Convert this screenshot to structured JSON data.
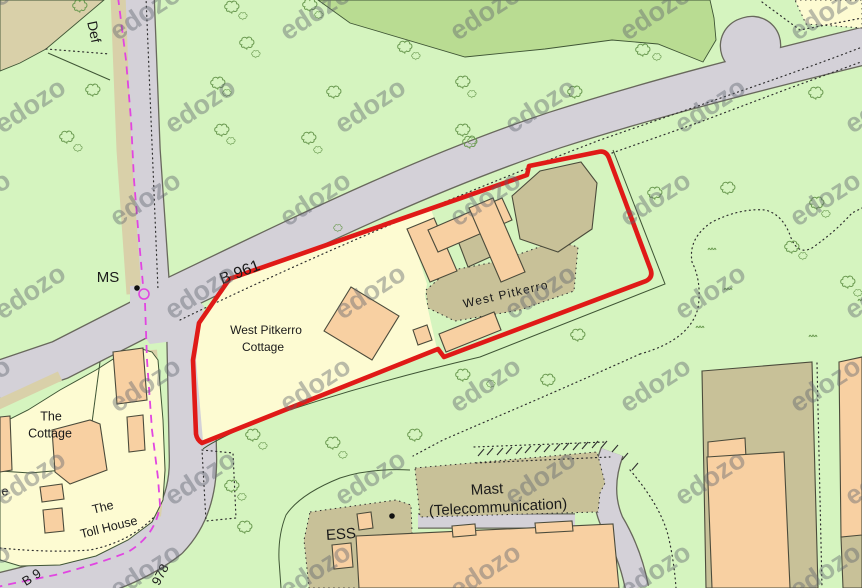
{
  "map": {
    "colors": {
      "green": "#d5f4bf",
      "olive": "#b9dc92",
      "tan": "#d9d0a9",
      "cream": "#fdfbd2",
      "gray": "#d4d1d8",
      "casing": "#68685c",
      "khaki": "#c8c198",
      "peach": "#f8d0a2",
      "building_outline": "#4b4b3b",
      "line": "#3f5535",
      "dotted": "#2f2f2f",
      "tree": "#6b9a51",
      "red": "#e01a17",
      "magenta": "#e145e1",
      "text": "#1a1a1a",
      "watermark": "#5f646e"
    },
    "watermark": {
      "text": "edozo",
      "rows": 7,
      "cols": 6,
      "dx": 170,
      "dy": 93,
      "x0": -20,
      "y0": 20,
      "odd_offset": 55,
      "rot": -33,
      "size": 27,
      "opacity": 0.42
    },
    "labels": [
      {
        "id": "label-def",
        "text": "Def",
        "x": 93,
        "y": 32,
        "rot": 78,
        "fs": 14
      },
      {
        "id": "label-ms",
        "text": "MS",
        "x": 108,
        "y": 278,
        "rot": 0,
        "fs": 15
      },
      {
        "id": "label-b961",
        "text": "B 961",
        "x": 240,
        "y": 273,
        "rot": -21,
        "fs": 16
      },
      {
        "id": "label-west-pitkerro-cottage-1",
        "text": "West Pitkerro",
        "x": 266,
        "y": 331,
        "rot": 0,
        "fs": 12
      },
      {
        "id": "label-west-pitkerro-cottage-2",
        "text": "Cottage",
        "x": 263,
        "y": 348,
        "rot": 0,
        "fs": 12
      },
      {
        "id": "label-west-pitkerro",
        "text": "West Pitkerro",
        "x": 506,
        "y": 295,
        "rot": -13,
        "fs": 12,
        "ls": 1.2
      },
      {
        "id": "label-the-cottage-1",
        "text": "The",
        "x": 51,
        "y": 417,
        "rot": 0,
        "fs": 12.5
      },
      {
        "id": "label-the-cottage-2",
        "text": "Cottage",
        "x": 50,
        "y": 434,
        "rot": 0,
        "fs": 12.5
      },
      {
        "id": "label-toll-house-1",
        "text": "The",
        "x": 103,
        "y": 508,
        "rot": -14,
        "fs": 12.5
      },
      {
        "id": "label-toll-house-2",
        "text": "Toll House",
        "x": 109,
        "y": 528,
        "rot": -14,
        "fs": 12.5
      },
      {
        "id": "label-e-partial",
        "text": "e",
        "x": 5,
        "y": 492,
        "rot": 0,
        "fs": 12.5
      },
      {
        "id": "label-ess",
        "text": "ESS",
        "x": 341,
        "y": 535,
        "rot": -4,
        "fs": 15
      },
      {
        "id": "label-mast-1",
        "text": "Mast",
        "x": 487,
        "y": 490,
        "rot": -3,
        "fs": 15
      },
      {
        "id": "label-mast-2",
        "text": "(Telecommunication)",
        "x": 498,
        "y": 508,
        "rot": -3,
        "fs": 15
      },
      {
        "id": "label-978",
        "text": "978",
        "x": 161,
        "y": 575,
        "rot": -62,
        "fs": 13
      },
      {
        "id": "label-b9-partial",
        "text": "B 9",
        "x": 32,
        "y": 578,
        "rot": -33,
        "fs": 13
      }
    ],
    "areas1": [
      {
        "name": "woodland-patch-top",
        "pts": "318,0 350,23 465,57 545,49 612,40 658,44 703,62 716,40 714,18 710,0",
        "fill": "olive",
        "stroke": true
      },
      {
        "name": "rough-ground-top-left",
        "pts": "0,0 104,0 46,49 20,63 0,71",
        "fill": "tan",
        "stroke": true
      }
    ],
    "roads": [
      {
        "name": "road-b961-main",
        "d": "M160,302 C300,235 420,175 555,130 C680,90 800,62 880,42",
        "w": 36
      },
      {
        "name": "road-layby-bulge",
        "d": "M749,46 L752,45",
        "w": 56,
        "cap": "round"
      },
      {
        "name": "road-north",
        "d": "M136,-5 L142,150 L152,296",
        "w": 35
      },
      {
        "name": "road-west",
        "d": "M162,308 L60,360 L-5,382",
        "w": 38
      },
      {
        "name": "road-south-b978",
        "d": "M190,312 L193,460 Q193,508 166,536 Q128,566 60,582 L-5,598",
        "w": 46
      },
      {
        "name": "road-mast-access",
        "d": "M418,521 L575,521",
        "w": 13
      },
      {
        "name": "road-southeast",
        "d": "M612,452 Q598,490 612,522 Q630,552 637,588",
        "w": 22
      }
    ],
    "verges": [
      {
        "name": "verge-north-road",
        "d": "M118,-5 L124,150 L134,294",
        "w": 15
      },
      {
        "name": "verge-south-road",
        "d": "M152,350 L161,470 L156,516",
        "w": 10
      },
      {
        "name": "verge-west-road",
        "d": "M60,376 L-5,406",
        "w": 10
      }
    ],
    "areas2": [
      {
        "name": "road-junction",
        "pts": "130,286 180,284 204,306 198,338 150,344 130,318",
        "fill": "gray"
      },
      {
        "name": "parcel-west-pitkerro-garden",
        "pts": "232,280 430,207 436,223 410,231 427,284 425,296 437,349 203,441 196,360 201,322",
        "fill": "cream"
      },
      {
        "name": "parcel-cottage-tollhouse",
        "pts": "0,424 28,410 60,390 96,370 118,356 142,349 152,352 158,360 163,420 165,470 163,500 152,522 128,540 96,556 60,565 20,566 0,560",
        "fill": "cream",
        "stroke": true
      },
      {
        "name": "parcel-top-right",
        "pts": "795,0 862,0 862,28 806,24",
        "fill": "cream",
        "dash": "1.5 3.5"
      },
      {
        "name": "yard-west-pitkerro",
        "pts": "426,290 448,271 500,261 556,241 578,247 574,291 520,310 455,321 428,308",
        "fill": "khaki",
        "dash": "1.5 3.5"
      },
      {
        "name": "compound-mast",
        "pts": "415,468 597,452 605,483 600,493 598,512 420,517",
        "fill": "khaki",
        "dash": "1.5 3.5"
      },
      {
        "name": "compound-ess",
        "pts": "310,512 396,500 411,505 414,588 309,588 304,540",
        "fill": "khaki",
        "dash": "1.5 3.5"
      }
    ],
    "fences": [
      {
        "name": "field-boundary-east",
        "d": "M613,150 L665,284 L480,357 Q360,385 260,420 Q215,440 203,449"
      },
      {
        "name": "field-boundary-ess-west",
        "d": "M410,470 Q370,468 340,478 Q300,494 286,515 Q278,535 279,560 L281,588"
      },
      {
        "name": "parcel-divider-1",
        "d": "M100,362 L86,468"
      },
      {
        "name": "parcel-divider-2",
        "d": "M86,468 L30,473 L0,471"
      },
      {
        "name": "boundary-top-left",
        "d": "M48,53 L110,80"
      }
    ],
    "dotted": [
      {
        "name": "path-edge-b961-south",
        "d": "M180,320 C320,252 470,190 600,140 C720,98 810,68 880,40"
      },
      {
        "name": "parcel-dotted-east",
        "d": "M612,153 L700,122 L790,88 L880,55"
      },
      {
        "name": "path-edge-north-road",
        "d": "M146,-3 L158,290"
      },
      {
        "name": "pen-below-site",
        "d": "M202,450 L233,453 L236,518 L206,521 L202,450"
      },
      {
        "name": "vegetation-line-east",
        "d": "M640,354 Q690,340 698,308 Q702,282 692,262 Q688,238 712,222 Q740,208 765,210 Q782,214 790,235 Q797,256 812,248 Q835,232 852,213 L862,208"
      },
      {
        "name": "vegetation-line-southeast",
        "d": "M640,354 Q560,390 480,424 L443,440 L413,456"
      },
      {
        "name": "parcel-bottom-dotted",
        "d": "M0,548 Q50,553 90,550 Q130,542 155,516"
      },
      {
        "name": "dotted-step-k4",
        "d": "M706,388 L730,386 L731,370 L812,364"
      },
      {
        "name": "dotted-k4-east",
        "d": "M817,363 L822,588"
      },
      {
        "name": "dotted-top-right",
        "d": "M762,2 L800,30 L862,18"
      },
      {
        "name": "cutting-edge-north",
        "d": "M474,447 L606,442"
      },
      {
        "name": "cutting-edge-south",
        "d": "M476,463 L610,457"
      },
      {
        "name": "boundary-dotted-top-left",
        "d": "M46,49 L110,54"
      },
      {
        "name": "road-edge-dotted-southeast",
        "d": "M630,470 Q660,505 668,535 Q674,560 676,588"
      }
    ],
    "hatch_ticks": [
      [
        478,
        456,
        484,
        449
      ],
      [
        487,
        455,
        493,
        448
      ],
      [
        497,
        455,
        503,
        448
      ],
      [
        506,
        454,
        512,
        447
      ],
      [
        516,
        454,
        522,
        447
      ],
      [
        525,
        453,
        531,
        446
      ],
      [
        535,
        452,
        541,
        445
      ],
      [
        544,
        452,
        550,
        445
      ],
      [
        554,
        451,
        560,
        444
      ],
      [
        563,
        450,
        569,
        443
      ],
      [
        573,
        450,
        579,
        443
      ],
      [
        582,
        449,
        588,
        442
      ],
      [
        592,
        448,
        598,
        441
      ],
      [
        601,
        448,
        607,
        441
      ],
      [
        612,
        452,
        618,
        445
      ],
      [
        622,
        460,
        628,
        453
      ],
      [
        632,
        470,
        638,
        463
      ]
    ],
    "buildings": [
      {
        "name": "building-khaki-main",
        "pts": "512,196 540,171 581,162 597,183 592,229 558,252 520,239",
        "fill": "khaki"
      },
      {
        "name": "building-khaki-middle",
        "pts": "455,233 486,220 499,253 468,267",
        "fill": "khaki"
      },
      {
        "name": "building-khaki-southeast-block",
        "pts": "702,371 812,362 818,588 706,588",
        "fill": "khaki"
      },
      {
        "name": "building-khaki-corner",
        "pts": "841,537 862,533 862,588 843,588",
        "fill": "khaki"
      },
      {
        "name": "building-west-pitkerro-cottage",
        "pts": "324,331 351,287 399,316 372,360",
        "fill": "peach"
      },
      {
        "name": "building-main-west-wing",
        "pts": "407,229 434,218 457,271 430,282",
        "fill": "peach"
      },
      {
        "name": "building-main-north-range",
        "pts": "428,230 502,198 512,220 438,252",
        "fill": "peach"
      },
      {
        "name": "building-main-east-wing",
        "pts": "469,208 493,198 525,272 501,282",
        "fill": "peach"
      },
      {
        "name": "building-outbuilding-small",
        "pts": "413,330 427,325 432,340 418,345",
        "fill": "peach"
      },
      {
        "name": "building-outbuilding-long",
        "pts": "439,334 494,312 501,330 446,352",
        "fill": "peach"
      },
      {
        "name": "building-se-annex-step",
        "pts": "708,442 745,438 746,458 708,460",
        "fill": "peach"
      },
      {
        "name": "building-se-annex",
        "pts": "707,457 784,452 790,588 712,588",
        "fill": "peach"
      },
      {
        "name": "building-east-edge",
        "pts": "839,362 862,357 862,535 841,537",
        "fill": "peach"
      },
      {
        "name": "building-bottom-large",
        "pts": "356,536 613,524 619,588 359,588",
        "fill": "peach"
      },
      {
        "name": "building-bottom-tab-1",
        "pts": "452,526 475,524 476,535 453,537",
        "fill": "peach"
      },
      {
        "name": "building-bottom-tab-2",
        "pts": "535,523 572,521 573,531 536,533",
        "fill": "peach"
      },
      {
        "name": "building-ess-hut-1",
        "pts": "357,514 371,512 373,528 359,530",
        "fill": "peach"
      },
      {
        "name": "building-ess-hut-2",
        "pts": "332,545 351,543 353,567 334,569",
        "fill": "peach"
      },
      {
        "name": "building-tollhouse-north",
        "pts": "113,352 143,348 147,400 117,404",
        "fill": "peach"
      },
      {
        "name": "building-the-cottage",
        "pts": "52,430 90,420 100,424 107,470 70,484 55,472",
        "fill": "peach"
      },
      {
        "name": "building-cottage-out-1",
        "pts": "40,487 62,484 64,499 42,502",
        "fill": "peach"
      },
      {
        "name": "building-tollhouse",
        "pts": "43,510 62,508 64,531 45,533",
        "fill": "peach"
      },
      {
        "name": "building-cottage-out-2",
        "pts": "127,417 143,415 145,450 129,452",
        "fill": "peach"
      },
      {
        "name": "building-left-edge",
        "pts": "0,417 10,416 12,470 0,472",
        "fill": "peach"
      }
    ],
    "trees": [
      [
        80,
        6,
        1
      ],
      [
        93,
        90,
        1
      ],
      [
        67,
        137,
        1
      ],
      [
        78,
        148,
        0.6
      ],
      [
        232,
        7,
        1
      ],
      [
        243,
        16,
        0.6
      ],
      [
        310,
        5,
        1
      ],
      [
        319,
        15,
        0.6
      ],
      [
        247,
        43,
        1
      ],
      [
        256,
        54,
        0.6
      ],
      [
        405,
        47,
        1
      ],
      [
        416,
        56,
        0.6
      ],
      [
        218,
        83,
        1
      ],
      [
        227,
        93,
        0.6
      ],
      [
        334,
        92,
        1
      ],
      [
        463,
        82,
        1
      ],
      [
        472,
        94,
        0.6
      ],
      [
        222,
        130,
        1
      ],
      [
        231,
        141,
        0.6
      ],
      [
        309,
        138,
        1
      ],
      [
        318,
        150,
        0.6
      ],
      [
        463,
        130,
        1
      ],
      [
        472,
        141,
        0.6
      ],
      [
        575,
        92,
        1
      ],
      [
        643,
        50,
        1
      ],
      [
        657,
        57,
        0.6
      ],
      [
        816,
        93,
        1
      ],
      [
        655,
        193,
        1
      ],
      [
        728,
        188,
        1
      ],
      [
        817,
        203,
        1
      ],
      [
        826,
        214,
        0.6
      ],
      [
        792,
        247,
        1
      ],
      [
        803,
        256,
        0.6
      ],
      [
        338,
        228,
        0.6
      ],
      [
        470,
        142,
        1
      ],
      [
        578,
        335,
        1
      ],
      [
        463,
        375,
        1
      ],
      [
        491,
        384,
        0.6
      ],
      [
        548,
        380,
        1
      ],
      [
        253,
        435,
        1
      ],
      [
        263,
        446,
        0.6
      ],
      [
        232,
        486,
        1
      ],
      [
        242,
        497,
        0.6
      ],
      [
        245,
        527,
        1
      ],
      [
        333,
        443,
        1
      ],
      [
        343,
        455,
        0.6
      ],
      [
        415,
        435,
        1
      ],
      [
        848,
        282,
        1
      ],
      [
        858,
        293,
        0.6
      ]
    ],
    "tufts": [
      [
        712,
        249
      ],
      [
        728,
        289
      ],
      [
        700,
        327
      ],
      [
        813,
        336
      ],
      [
        862,
        300
      ]
    ],
    "boundary_red": {
      "name": "site-boundary-red",
      "d": "M232,278 L527,175 L529,166 L598,152 Q606,150 609,158 L650,268 Q654,277 646,281 L444,357 L438,349 L202,443 Q197,440 196,434 L193,360 L199,323 L228,281 Q230,278 232,278 Z",
      "w": 4.6
    },
    "boundary_magenta": {
      "name": "admin-boundary-magenta",
      "paths": [
        "M118,-3 L126,60 L131,120 L134,180 L139,240 L143,285",
        "M145,303 L147,360 L152,430 L158,478 L160,505 Q156,535 128,552 Q95,565 55,575 L15,583 L-3,587"
      ],
      "circle": [
        144,
        294,
        5
      ]
    },
    "dots": [
      {
        "name": "mast-symbol-dot-ms",
        "c": [
          137,
          288
        ]
      },
      {
        "name": "mast-symbol-dot-ess",
        "c": [
          392,
          516
        ]
      }
    ]
  }
}
